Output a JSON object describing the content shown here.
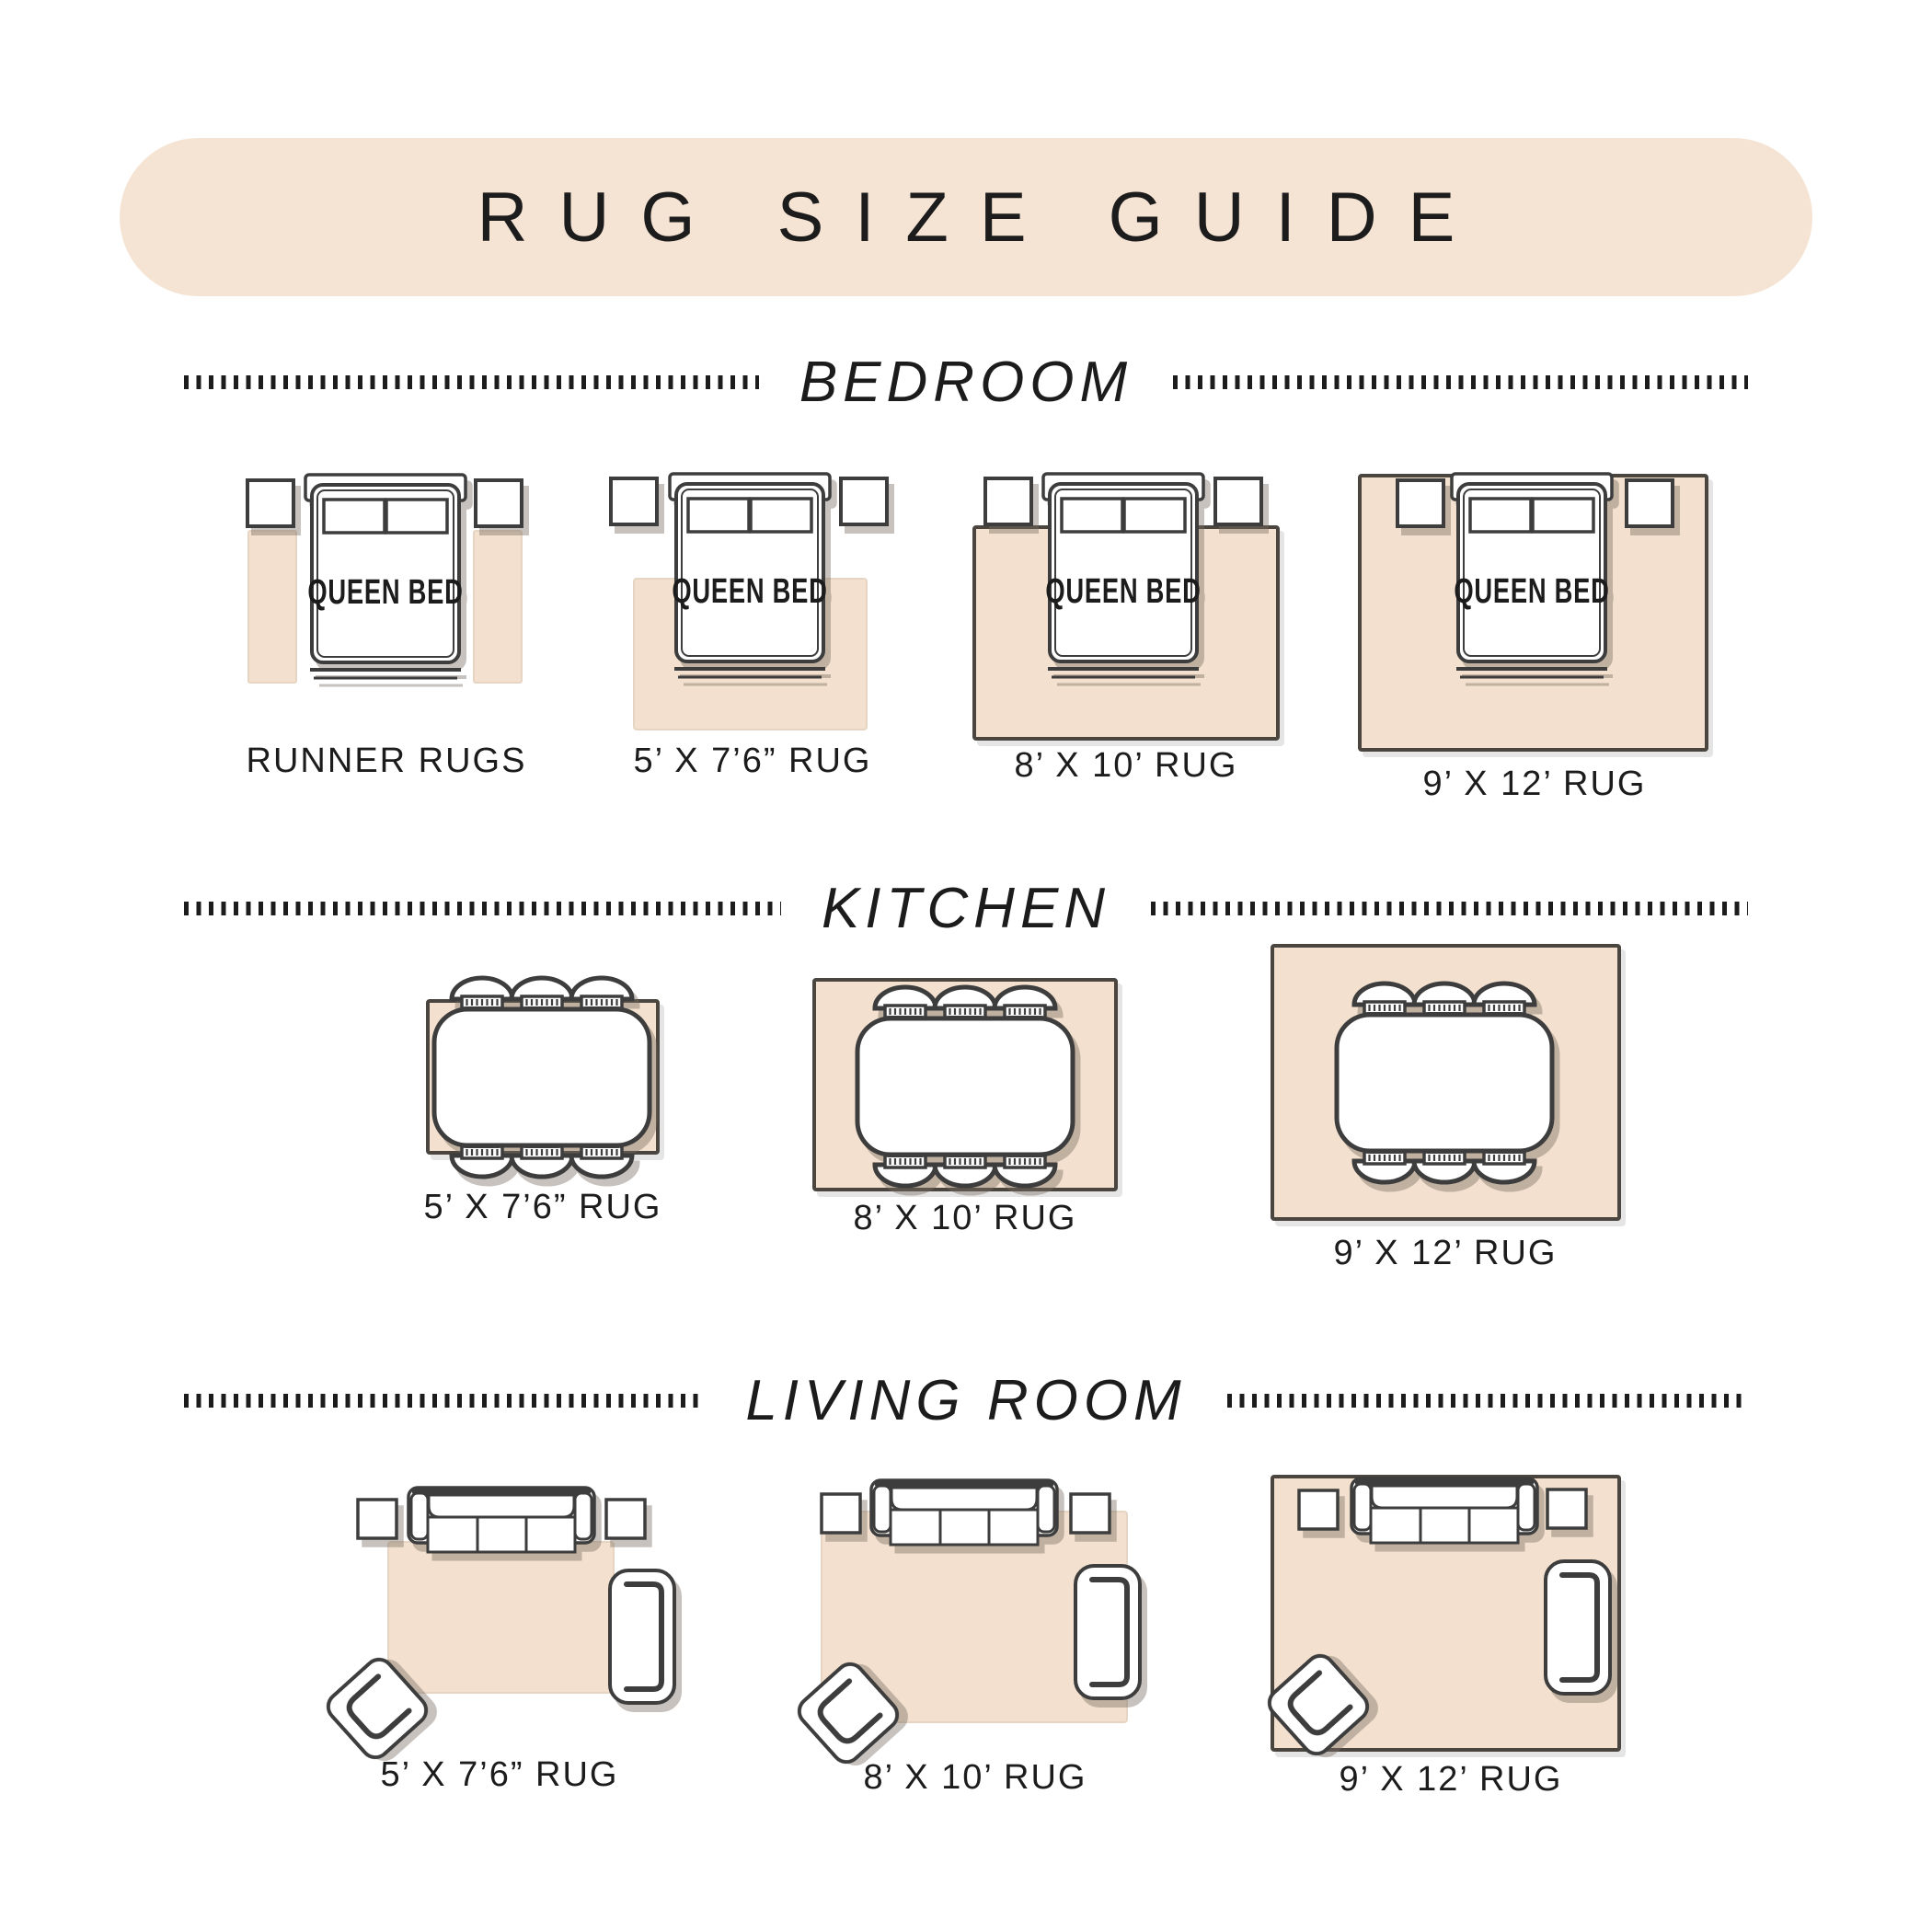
{
  "title": "RUG SIZE GUIDE",
  "bed_label": "QUEEN BED",
  "sections": {
    "bedroom": {
      "title": "BEDROOM",
      "items": [
        {
          "label": "RUNNER RUGS"
        },
        {
          "label": "5’ X 7’6” RUG"
        },
        {
          "label": "8’ X 10’ RUG"
        },
        {
          "label": "9’ X 12’ RUG"
        }
      ]
    },
    "kitchen": {
      "title": "KITCHEN",
      "items": [
        {
          "label": "5’ X 7’6” RUG"
        },
        {
          "label": "8’ X 10’ RUG"
        },
        {
          "label": "9’ X 12’ RUG"
        }
      ]
    },
    "living_room": {
      "title": "LIVING ROOM",
      "items": [
        {
          "label": "5’ X 7’6” RUG"
        },
        {
          "label": "8’ X 10’ RUG"
        },
        {
          "label": "9’ X 12’ RUG"
        }
      ]
    }
  },
  "colors": {
    "banner": "#f5e3d3",
    "rug": "#f3e0ce",
    "stroke": "#3d3d3d",
    "ink": "#1c1c1c",
    "rugline": "#e6d5c3",
    "shadow": "rgba(122,109,97,0.42)"
  }
}
